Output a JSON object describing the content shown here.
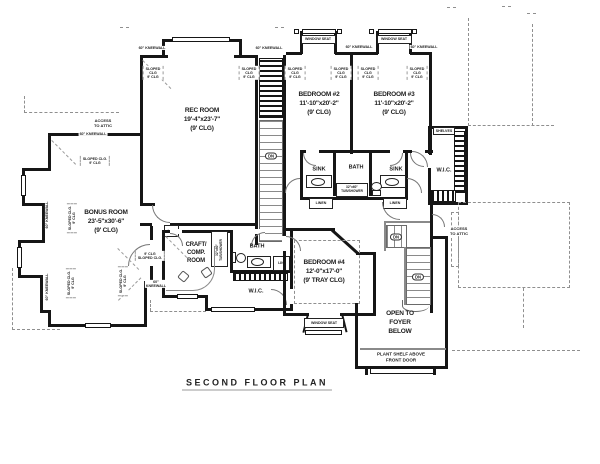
{
  "title": "SECOND FLOOR PLAN",
  "rooms": {
    "rec": "REC ROOM\n19'-4\"x23'-7\"\n(9' CLG)",
    "bed2": "BEDROOM #2\n11'-10\"x20'-2\"\n(9' CLG)",
    "bed3": "BEDROOM #3\n11'-10\"x20'-2\"\n(9' CLG)",
    "bonus": "BONUS ROOM\n23'-5\"x30'-6\"\n(9' CLG)",
    "bed4": "BEDROOM #4\n12'-0\"x17'-0\"\n(9' TRAY CLG)",
    "craft": "CRAFT/\nCOMP.\nROOM",
    "foyer": "OPEN TO\nFOYER\nBELOW",
    "plant_shelf": "PLANT SHELF ABOVE\nFRONT DOOR"
  },
  "labels": {
    "bath": "BATH",
    "sink": "SINK",
    "wic": "W.I.C.",
    "linen": "LINEN",
    "lin": "LIN",
    "lc": "L.C.",
    "shelves": "SHELVES",
    "dn": "DN",
    "tub": "32\"x60\"\nTUB/SHOWER",
    "window_seat": "WINDOW SEAT",
    "kneewall": "60\" KNEEWALL",
    "kneewall_2line": "60\"\nKNEEWALL",
    "sloped": "SLOPED\nCLG\n9' CLG",
    "sloped_2line": "SLOPED CLG.\n9' CLG",
    "sloped_inline": "9' CLG\nSLOPED CLG.",
    "access_attic": "ACCESS\nTO ATTIC"
  },
  "colors": {
    "wall": "#161616",
    "dash": "#8f8f8f",
    "text": "#1c1c1c"
  }
}
